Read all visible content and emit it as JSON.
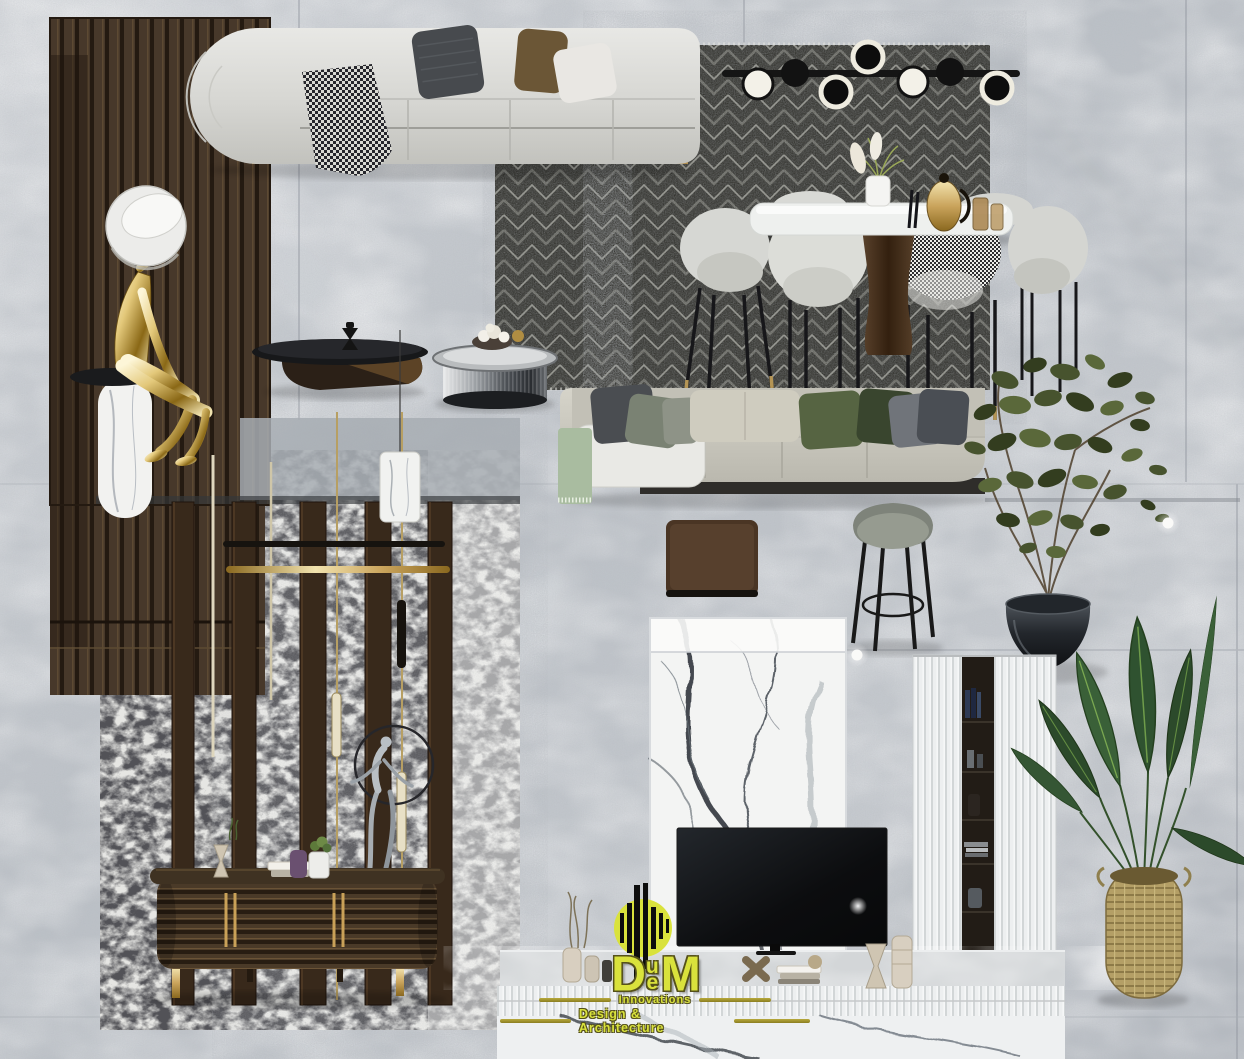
{
  "logo": {
    "mark": "striped-circle-monogram",
    "word_d": "D",
    "word_u": "u",
    "word_e": "e",
    "word_m": "M",
    "tagline1": "Innovations",
    "tagline2": "Design & Architecture"
  },
  "palette": {
    "floor_gray": "#c6cad0",
    "wood_panel_brown": "#47382a",
    "rug_charcoal": "#33332e",
    "sofa_fabric_light": "#d9d9d5",
    "accent_gold": "#c9a158",
    "pillow_green": "#566442",
    "marble_white": "#f2f3f2",
    "logo_yellow": "#d9e23c",
    "logo_olive": "#938627"
  },
  "scene": {
    "items": [
      "curved sofa with pillows and houndstooth throw",
      "linear black chandelier",
      "chevron rug",
      "dining table with marble top",
      "upholstered dining chairs",
      "straight modular sofa",
      "olive tree in metal bowl",
      "leather floor panel",
      "bar stool",
      "gold mannequin sculpture on marble pedestal",
      "slatted wood wall panel",
      "brass pendant rods",
      "marble cylinder pendant lamp",
      "ring and figurine sculpture",
      "ribbed wood console with gold handles",
      "distressed black and white rug",
      "white marble TV wall",
      "television",
      "fluted tall cabinets with shelf niche",
      "fluted media shelf with decor",
      "white marble base slab",
      "banana plant in woven basket",
      "recessed floor spotlights"
    ]
  }
}
